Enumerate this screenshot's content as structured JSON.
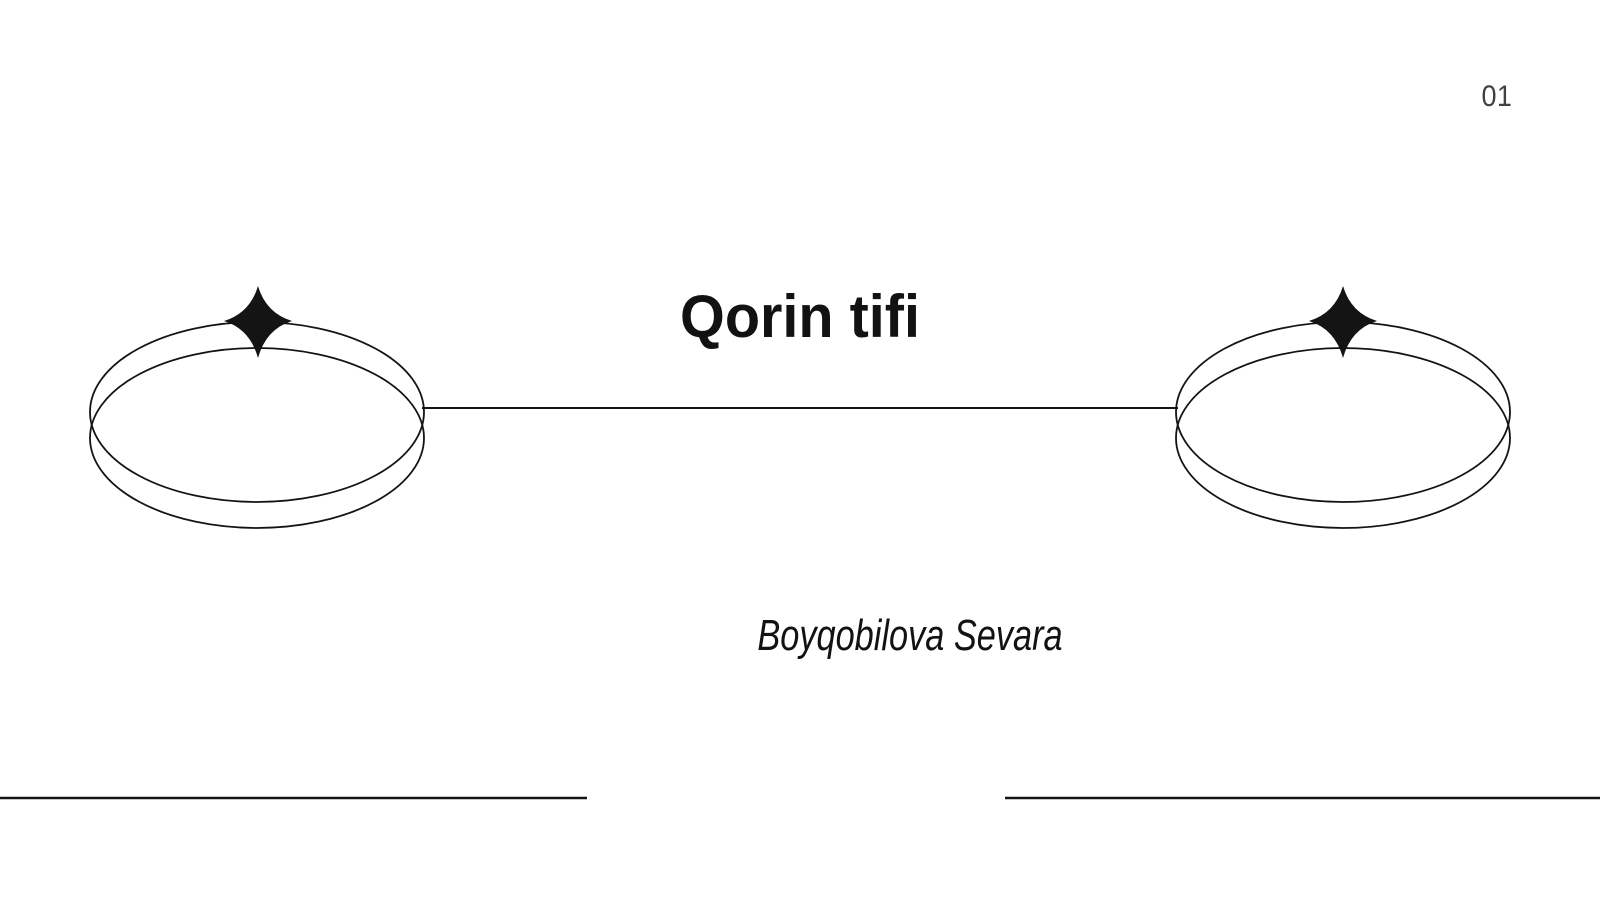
{
  "slide": {
    "page_number": "01",
    "title": "Qorin tifi",
    "author": "Boyqobilova Sevara"
  },
  "colors": {
    "background": "#ffffff",
    "ink": "#141414",
    "page_number_text": "#3d4247"
  },
  "decor": {
    "left_ring": "double-ellipse-ring",
    "right_ring": "double-ellipse-ring",
    "left_star": "four-point-sparkle",
    "right_star": "four-point-sparkle",
    "connector": "horizontal-connector-line",
    "footer_left": "horizontal-rule",
    "footer_right": "horizontal-rule"
  }
}
